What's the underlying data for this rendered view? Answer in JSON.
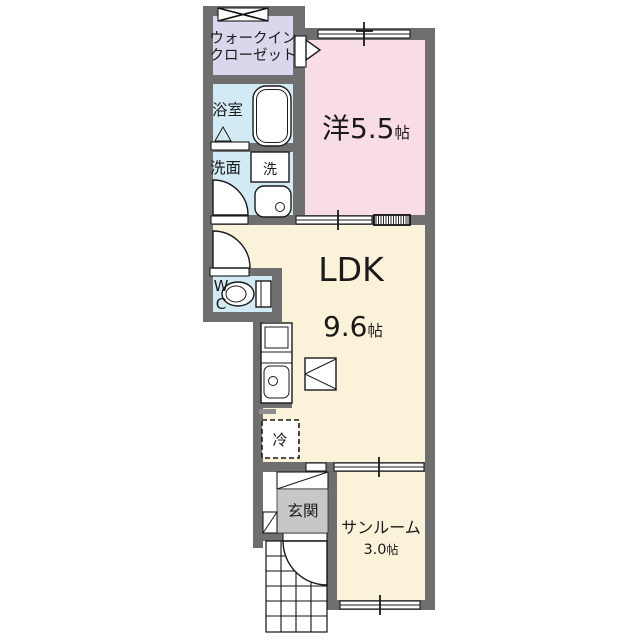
{
  "plan_title": "1LDK apartment floor plan",
  "colors": {
    "background": "#ffffff",
    "wall": "#6f6f70",
    "western_room": "#f8dce6",
    "ldk_room": "#faf3d9",
    "closet": "#d8d7eb",
    "wet_area": "#d2eaf4",
    "entrance_floor": "#c7c7c6",
    "line": "#1a1a1a"
  },
  "rooms": {
    "walk_in_closet": {
      "label_line1": "ウォークイン",
      "label_line2": "クローゼット"
    },
    "bathroom": {
      "label": "浴室"
    },
    "washroom": {
      "label": "洗面"
    },
    "washing_machine": {
      "label": "洗"
    },
    "western_room": {
      "label": "洋5.5",
      "unit": "帖"
    },
    "ldk": {
      "label": "LDK",
      "size": "9.6",
      "unit": "帖"
    },
    "wc": {
      "label_line1": "W",
      "label_line2": "C"
    },
    "refrigerator": {
      "label": "冷"
    },
    "entrance": {
      "label": "玄関"
    },
    "sunroom": {
      "label": "サンルーム",
      "size": "3.0",
      "unit": "帖"
    }
  }
}
